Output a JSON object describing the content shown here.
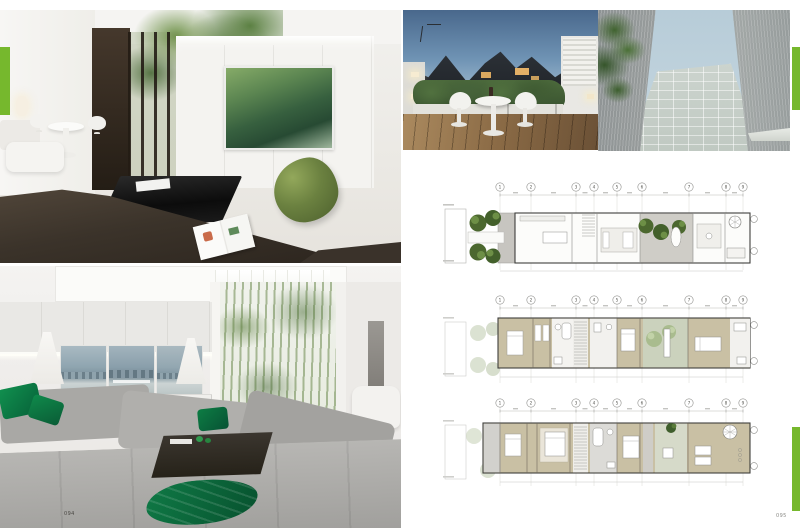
{
  "page": {
    "accent_color": "#76b82d",
    "left_page_number": "094",
    "right_page_number": "095"
  },
  "photos": [
    {
      "name": "living-room-moss-beanbag",
      "description": "White living room with dark folding doors, bamboo garden, green mountain artwork, moss beanbag, black coffee table and dark brown sofa"
    },
    {
      "name": "rooftop-terrace",
      "description": "Evening rooftop terrace with timber deck, hedge planters, glowing wall lamps and white tulip table with two chairs"
    },
    {
      "name": "building-facade",
      "description": "View looking up between two concrete walls at a gridded louvre facade, sky and bamboo leaves"
    },
    {
      "name": "living-room-gray-sectional",
      "description": "Living room with white cabinetry, Venice triptych artwork, table lamps, bamboo lightwell, gray sectional sofa with emerald green cushions and throw"
    }
  ],
  "plans": {
    "grid_labels": [
      "1",
      "2",
      "3",
      "4",
      "5",
      "6",
      "7",
      "8",
      "9"
    ],
    "levels": [
      {
        "name": "ground-floor-plan"
      },
      {
        "name": "first-floor-plan"
      },
      {
        "name": "second-floor-plan"
      }
    ],
    "colors": {
      "room_tan": "#c9c0a4",
      "courtyard_green": "#cbd2bd",
      "tree_green": "#4c682f",
      "plan_gray": "#cfcdc7"
    }
  }
}
